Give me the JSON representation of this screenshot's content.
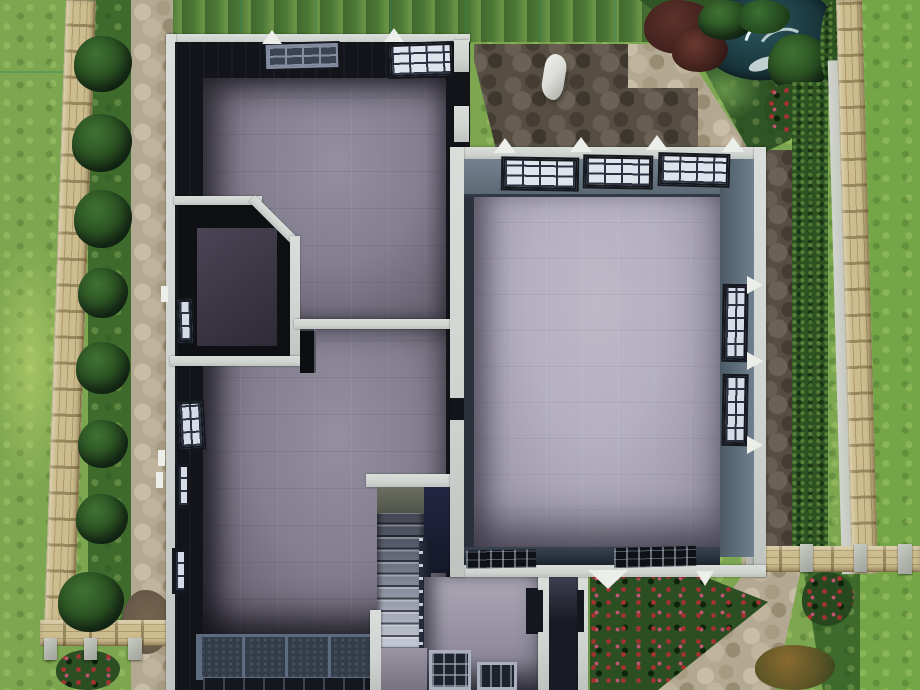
{
  "labels": {
    "scene": "Top-down build-mode view of a house upper floor with garden, fences, paths, pond and fountain",
    "house": "Unfurnished upper floor with four rooms, closet and staircase",
    "great_room": "Large room with light tile floor and grid windows",
    "left_rooms": "Two grey-floored rooms with corner closet",
    "stairs": "Staircase descending to lower floor",
    "pond": "Garden pond with fountain spray",
    "patio": "Dark cobblestone patio",
    "statue": "Small white garden ornament"
  },
  "environment": {
    "plants": [
      "hedgerow bushes",
      "rose bush",
      "red flower bed",
      "maroon shrubs",
      "ferns",
      "orange shrub"
    ],
    "paths": [
      "left cobblestone walk",
      "dark patio",
      "top-right walk",
      "right-side dark path",
      "bottom-right walk",
      "dirt patch"
    ],
    "fences": [
      "left wooden fence",
      "right wooden fence",
      "bottom-left wooden fence",
      "bottom-right wooden fence"
    ],
    "water": [
      "pond",
      "fountain-spray"
    ]
  },
  "house": {
    "rooms": [
      "top-left room",
      "bottom-left room",
      "closet",
      "great room",
      "stair landing room",
      "side corridor"
    ],
    "window_count": 16,
    "door_count": 2,
    "stairs_steps": 13
  },
  "palette": {
    "grassBase": "#7CA64F",
    "grassTopDark": "#4D7A36",
    "grassRight": "#74A647",
    "grassDeep": "#3E6B2C",
    "gridLine": "#2F8468",
    "fenceWood": "#CDBD8E",
    "fenceRail": "#97875C",
    "curb": "#C5C7C1",
    "pathLight": "#B3A891",
    "pathStoneLight": "#C8BDA6",
    "pathStoneDark": "#988C73",
    "patioBase": "#564E43",
    "patioStone": "#6B6154",
    "dirt": "#6A5C49",
    "bush": "#26491F",
    "bushLight": "#3F7232",
    "hedge": "#2D5323",
    "pond": "#2B565C",
    "pondDeep": "#11292F",
    "fountain": "#EAF6F6",
    "maroonBush": "#5C322A",
    "roseRed": "#A63230",
    "rosePink": "#C25672",
    "wallCap": "#D0D4D0",
    "wallDark": "#121419",
    "blueWallLight": "#74828F",
    "blueWallDark": "#4C5A66",
    "floorLeft": "#847F8F",
    "floorLeftDark": "#554F5E",
    "floorRight": "#B4B0C0",
    "floorRightDark": "#8C8898",
    "windowFrame": "#14171E",
    "windowPaneLight": "#DFE4EC",
    "windowPaneDark": "#3C4352",
    "stairLight": "#C9CDD9",
    "navyPanel": "#222642",
    "corridorDark": "#191B24",
    "doorDark": "#0C0E12",
    "bankFrame": "#5D6B7E",
    "bankFill": "#333D4A",
    "statue": "#DADBD6"
  }
}
